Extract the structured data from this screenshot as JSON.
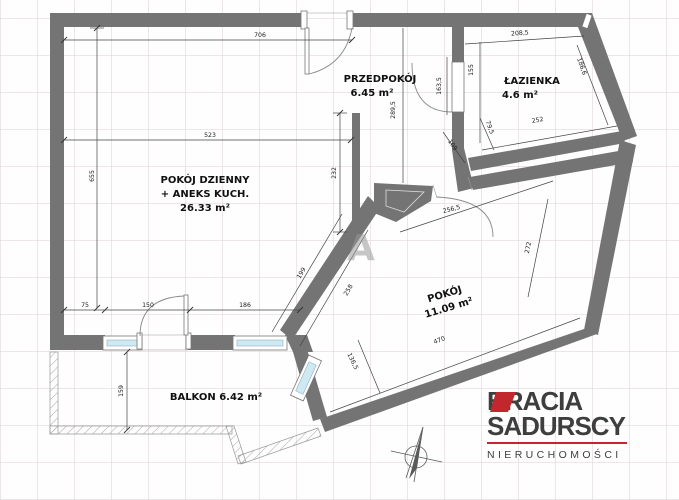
{
  "plan": {
    "watermark": "A",
    "rooms": {
      "living": {
        "name": "POKÓJ DZIENNY",
        "name2": "+ ANEKS KUCH.",
        "area": "26.33 m²"
      },
      "hall": {
        "name": "PRZEDPOKÓJ",
        "area": "6.45 m²"
      },
      "bath": {
        "name": "ŁAZIENKA",
        "area": "4.6 m²"
      },
      "room": {
        "name": "POKÓJ",
        "area": "11.09 m²"
      },
      "balcony": {
        "name": "BALKON 6.42 m²"
      }
    },
    "dims": {
      "d706": "706",
      "d523": "523",
      "d655": "655",
      "d75": "75",
      "d150": "150",
      "d186": "186",
      "d159": "159",
      "d232": "232",
      "d289": "289,5",
      "d163": "163,5",
      "d155": "155",
      "d208": "208,5",
      "d186b": "186,6",
      "d252": "252",
      "d79": "79,5",
      "d109": "109",
      "d256": "256,5",
      "d272": "272",
      "d258": "258",
      "d199": "199",
      "d470": "470",
      "d136": "136,5"
    }
  },
  "logo": {
    "brand_top": "BRACIA",
    "brand_bottom": "SADURSCY",
    "tagline": "NIERUCHOMOŚCI"
  },
  "colors": {
    "wall": "#747474",
    "accent": "#c2272d",
    "window_glass": "#cfe9f2"
  }
}
